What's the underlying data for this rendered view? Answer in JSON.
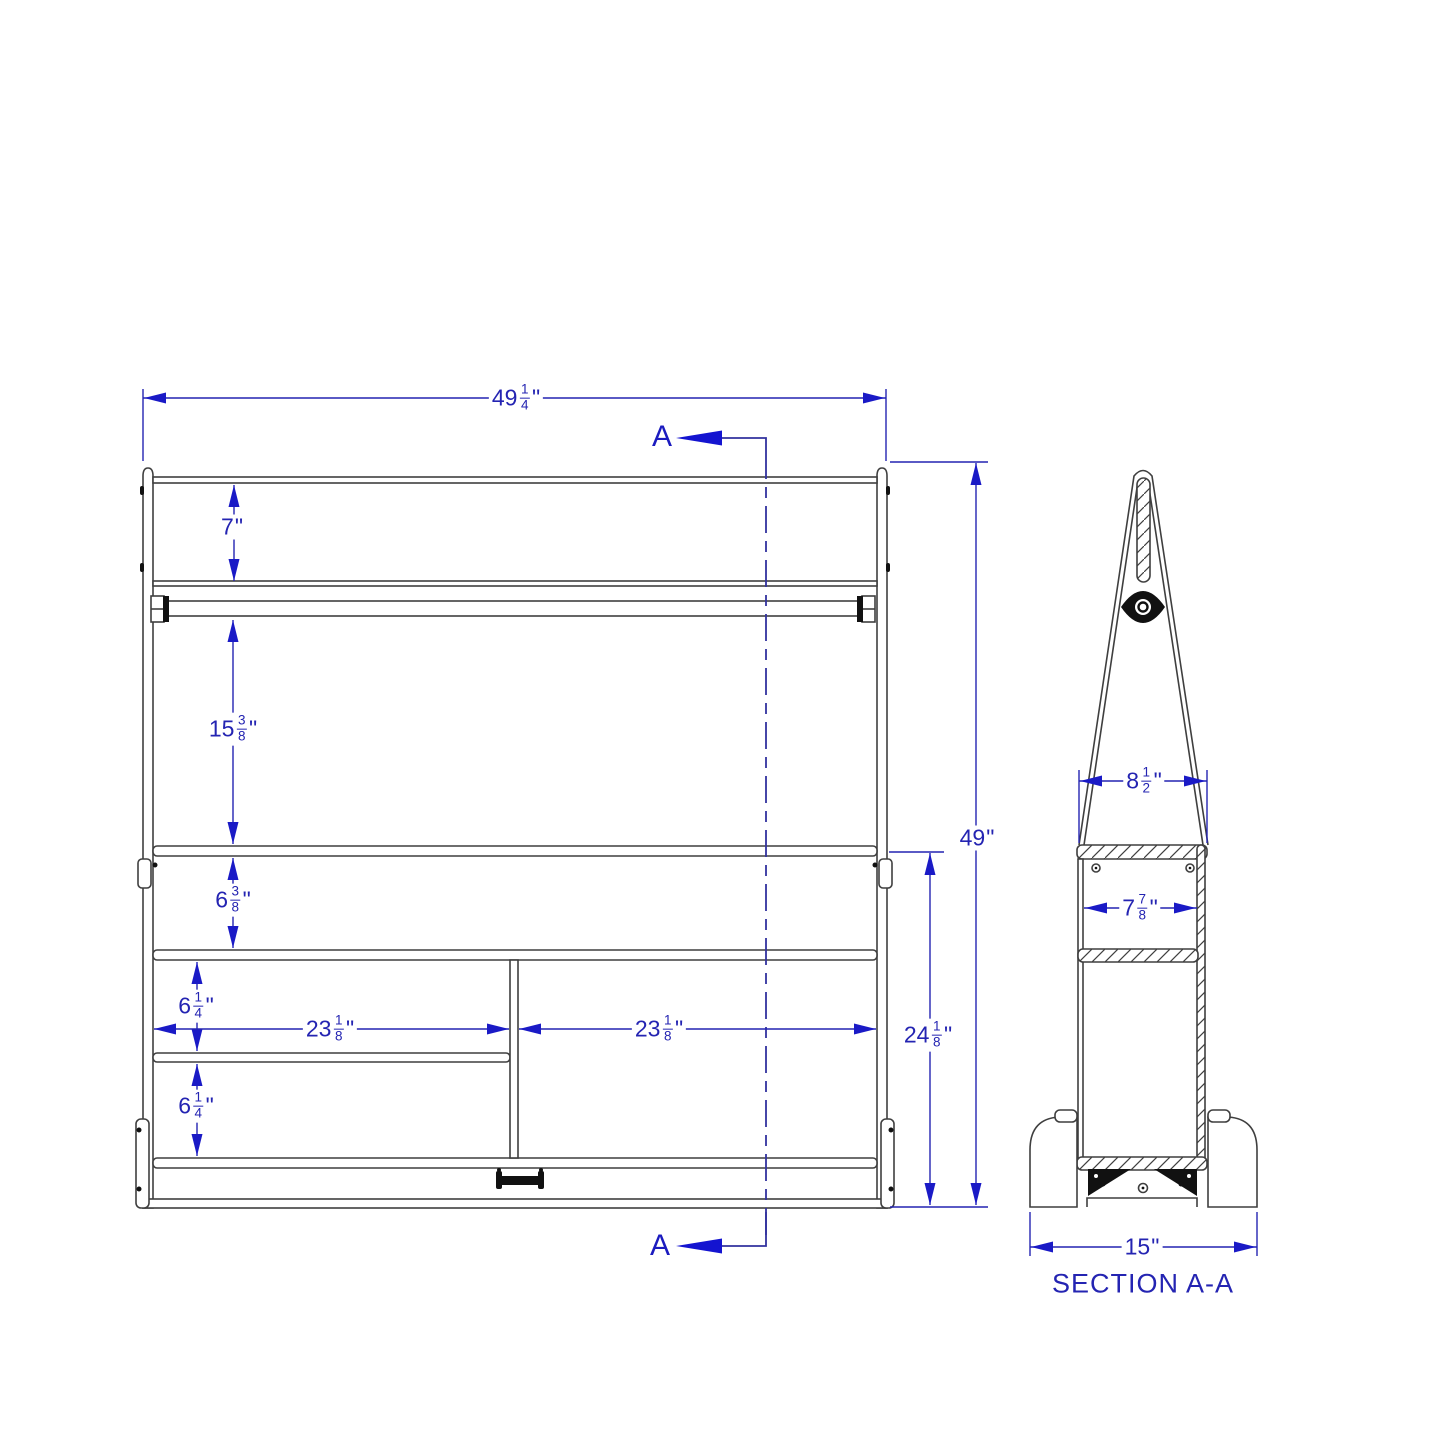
{
  "drawing": {
    "front_view": {
      "section_marker": "A",
      "dim_overall_width": {
        "whole": "49",
        "num": "1",
        "den": "4",
        "unit": "\""
      },
      "dim_top_rail_height": {
        "whole": "7",
        "unit": "\""
      },
      "dim_rod_to_shelf": {
        "whole": "15",
        "num": "3",
        "den": "8",
        "unit": "\""
      },
      "dim_shelf_gap_top": {
        "whole": "6",
        "num": "3",
        "den": "8",
        "unit": "\""
      },
      "dim_shelf_gap_mid": {
        "whole": "6",
        "num": "1",
        "den": "4",
        "unit": "\""
      },
      "dim_shelf_gap_bottom": {
        "whole": "6",
        "num": "1",
        "den": "4",
        "unit": "\""
      },
      "dim_compartment_left": {
        "whole": "23",
        "num": "1",
        "den": "8",
        "unit": "\""
      },
      "dim_compartment_right": {
        "whole": "23",
        "num": "1",
        "den": "8",
        "unit": "\""
      },
      "dim_lower_section_height": {
        "whole": "24",
        "num": "1",
        "den": "8",
        "unit": "\""
      },
      "dim_overall_height": {
        "whole": "49",
        "unit": "\""
      }
    },
    "section_view": {
      "title": "SECTION A-A",
      "dim_upper_width": {
        "whole": "8",
        "num": "1",
        "den": "2",
        "unit": "\""
      },
      "dim_shelf_depth": {
        "whole": "7",
        "num": "7",
        "den": "8",
        "unit": "\""
      },
      "dim_base_depth": {
        "whole": "15",
        "unit": "\""
      }
    },
    "colors": {
      "dimension_blue": "#2424b2",
      "arrow_blue": "#1a1ac6",
      "section_line_blue": "#32329e",
      "geometry_gray": "#3f3f3f"
    }
  }
}
